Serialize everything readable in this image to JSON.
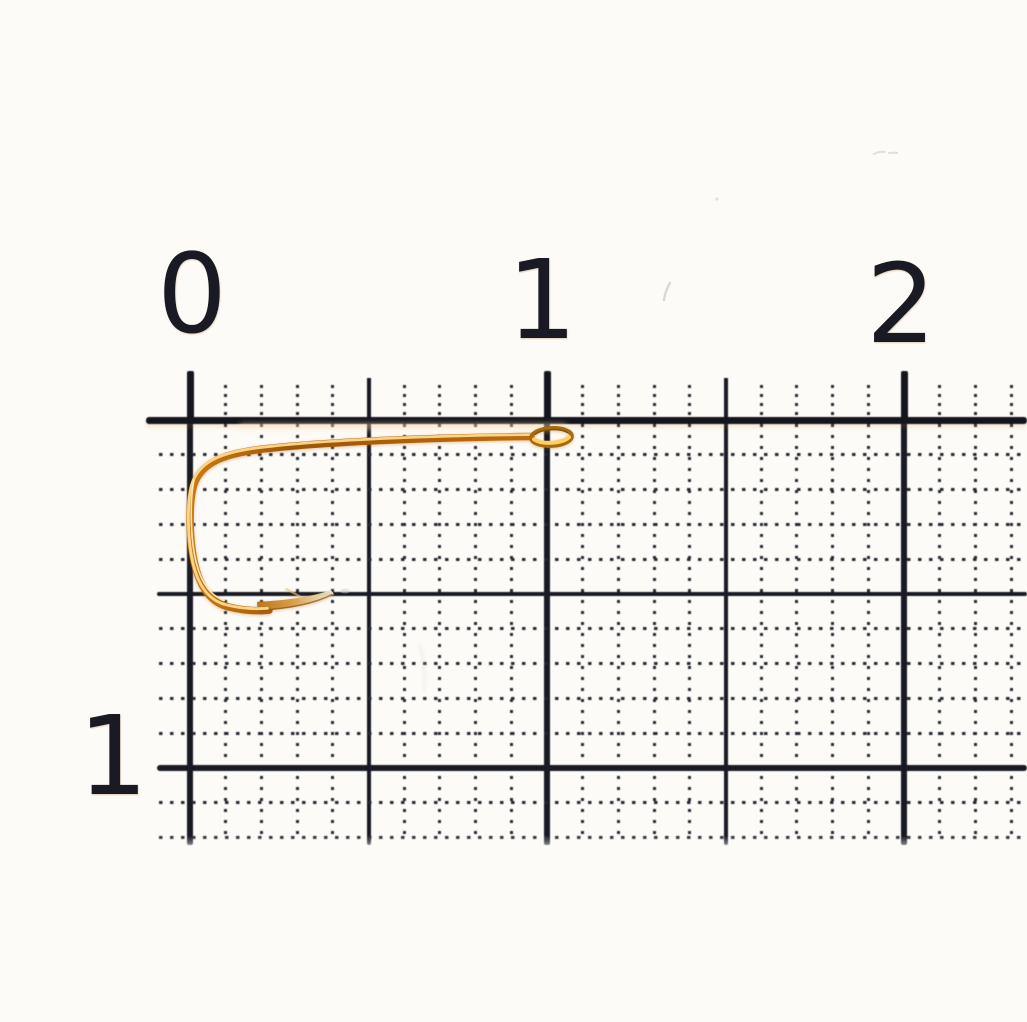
{
  "photo": {
    "description": "Macro photo of a small gold fly-fishing hook lying on millimeter graph paper beneath a centimeter ruler scale",
    "subject": "gold fishing hook"
  },
  "ruler": {
    "top_labels": [
      "0",
      "1",
      "2"
    ],
    "side_labels": [
      "1"
    ]
  },
  "colors": {
    "paper": "#fcfbf7",
    "ink": "#191a23",
    "ink_soft": "#262833",
    "hook_dark": "#9c5607",
    "hook_mid": "#cd7911",
    "hook_light": "#ffd98e",
    "hook_pale": "#fff1c8"
  }
}
